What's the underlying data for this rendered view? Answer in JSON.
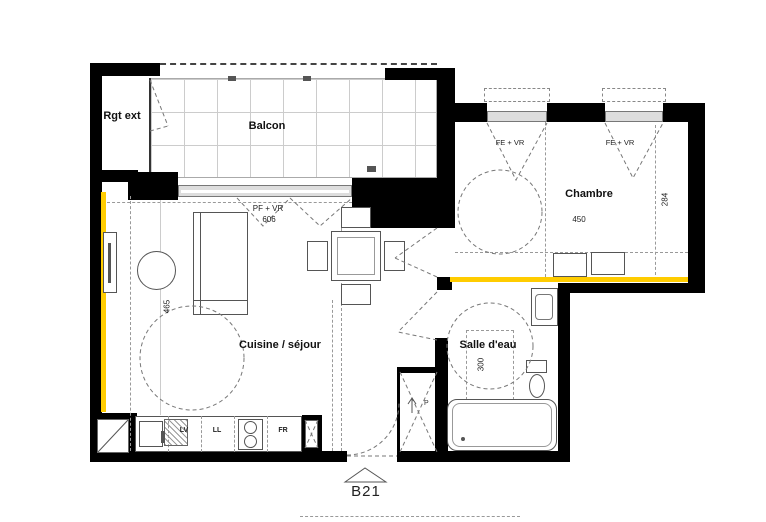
{
  "unit": {
    "label": "B21"
  },
  "rooms": {
    "balcon": {
      "label": "Balcon"
    },
    "rgt_ext": {
      "label": "Rgt ext"
    },
    "chambre": {
      "label": "Chambre",
      "width_cm": "450",
      "depth_cm": "284"
    },
    "cuisine_sejour": {
      "label": "Cuisine / séjour",
      "depth_cm": "465"
    },
    "salle_deau": {
      "label": "Salle d'eau",
      "clearance_cm": "300"
    }
  },
  "openings": {
    "balcony_bay": {
      "label": "PF + VR",
      "width_cm": "606"
    },
    "bedroom_window_1": {
      "label": "FE + VR"
    },
    "bedroom_window_2": {
      "label": "FE + VR"
    }
  },
  "appliances": {
    "dishwasher": "LV",
    "washer": "LL",
    "fridge": "FR"
  },
  "closet": {
    "label": "P"
  },
  "colors": {
    "wall": "#000000",
    "accent": "#ffcc00"
  }
}
